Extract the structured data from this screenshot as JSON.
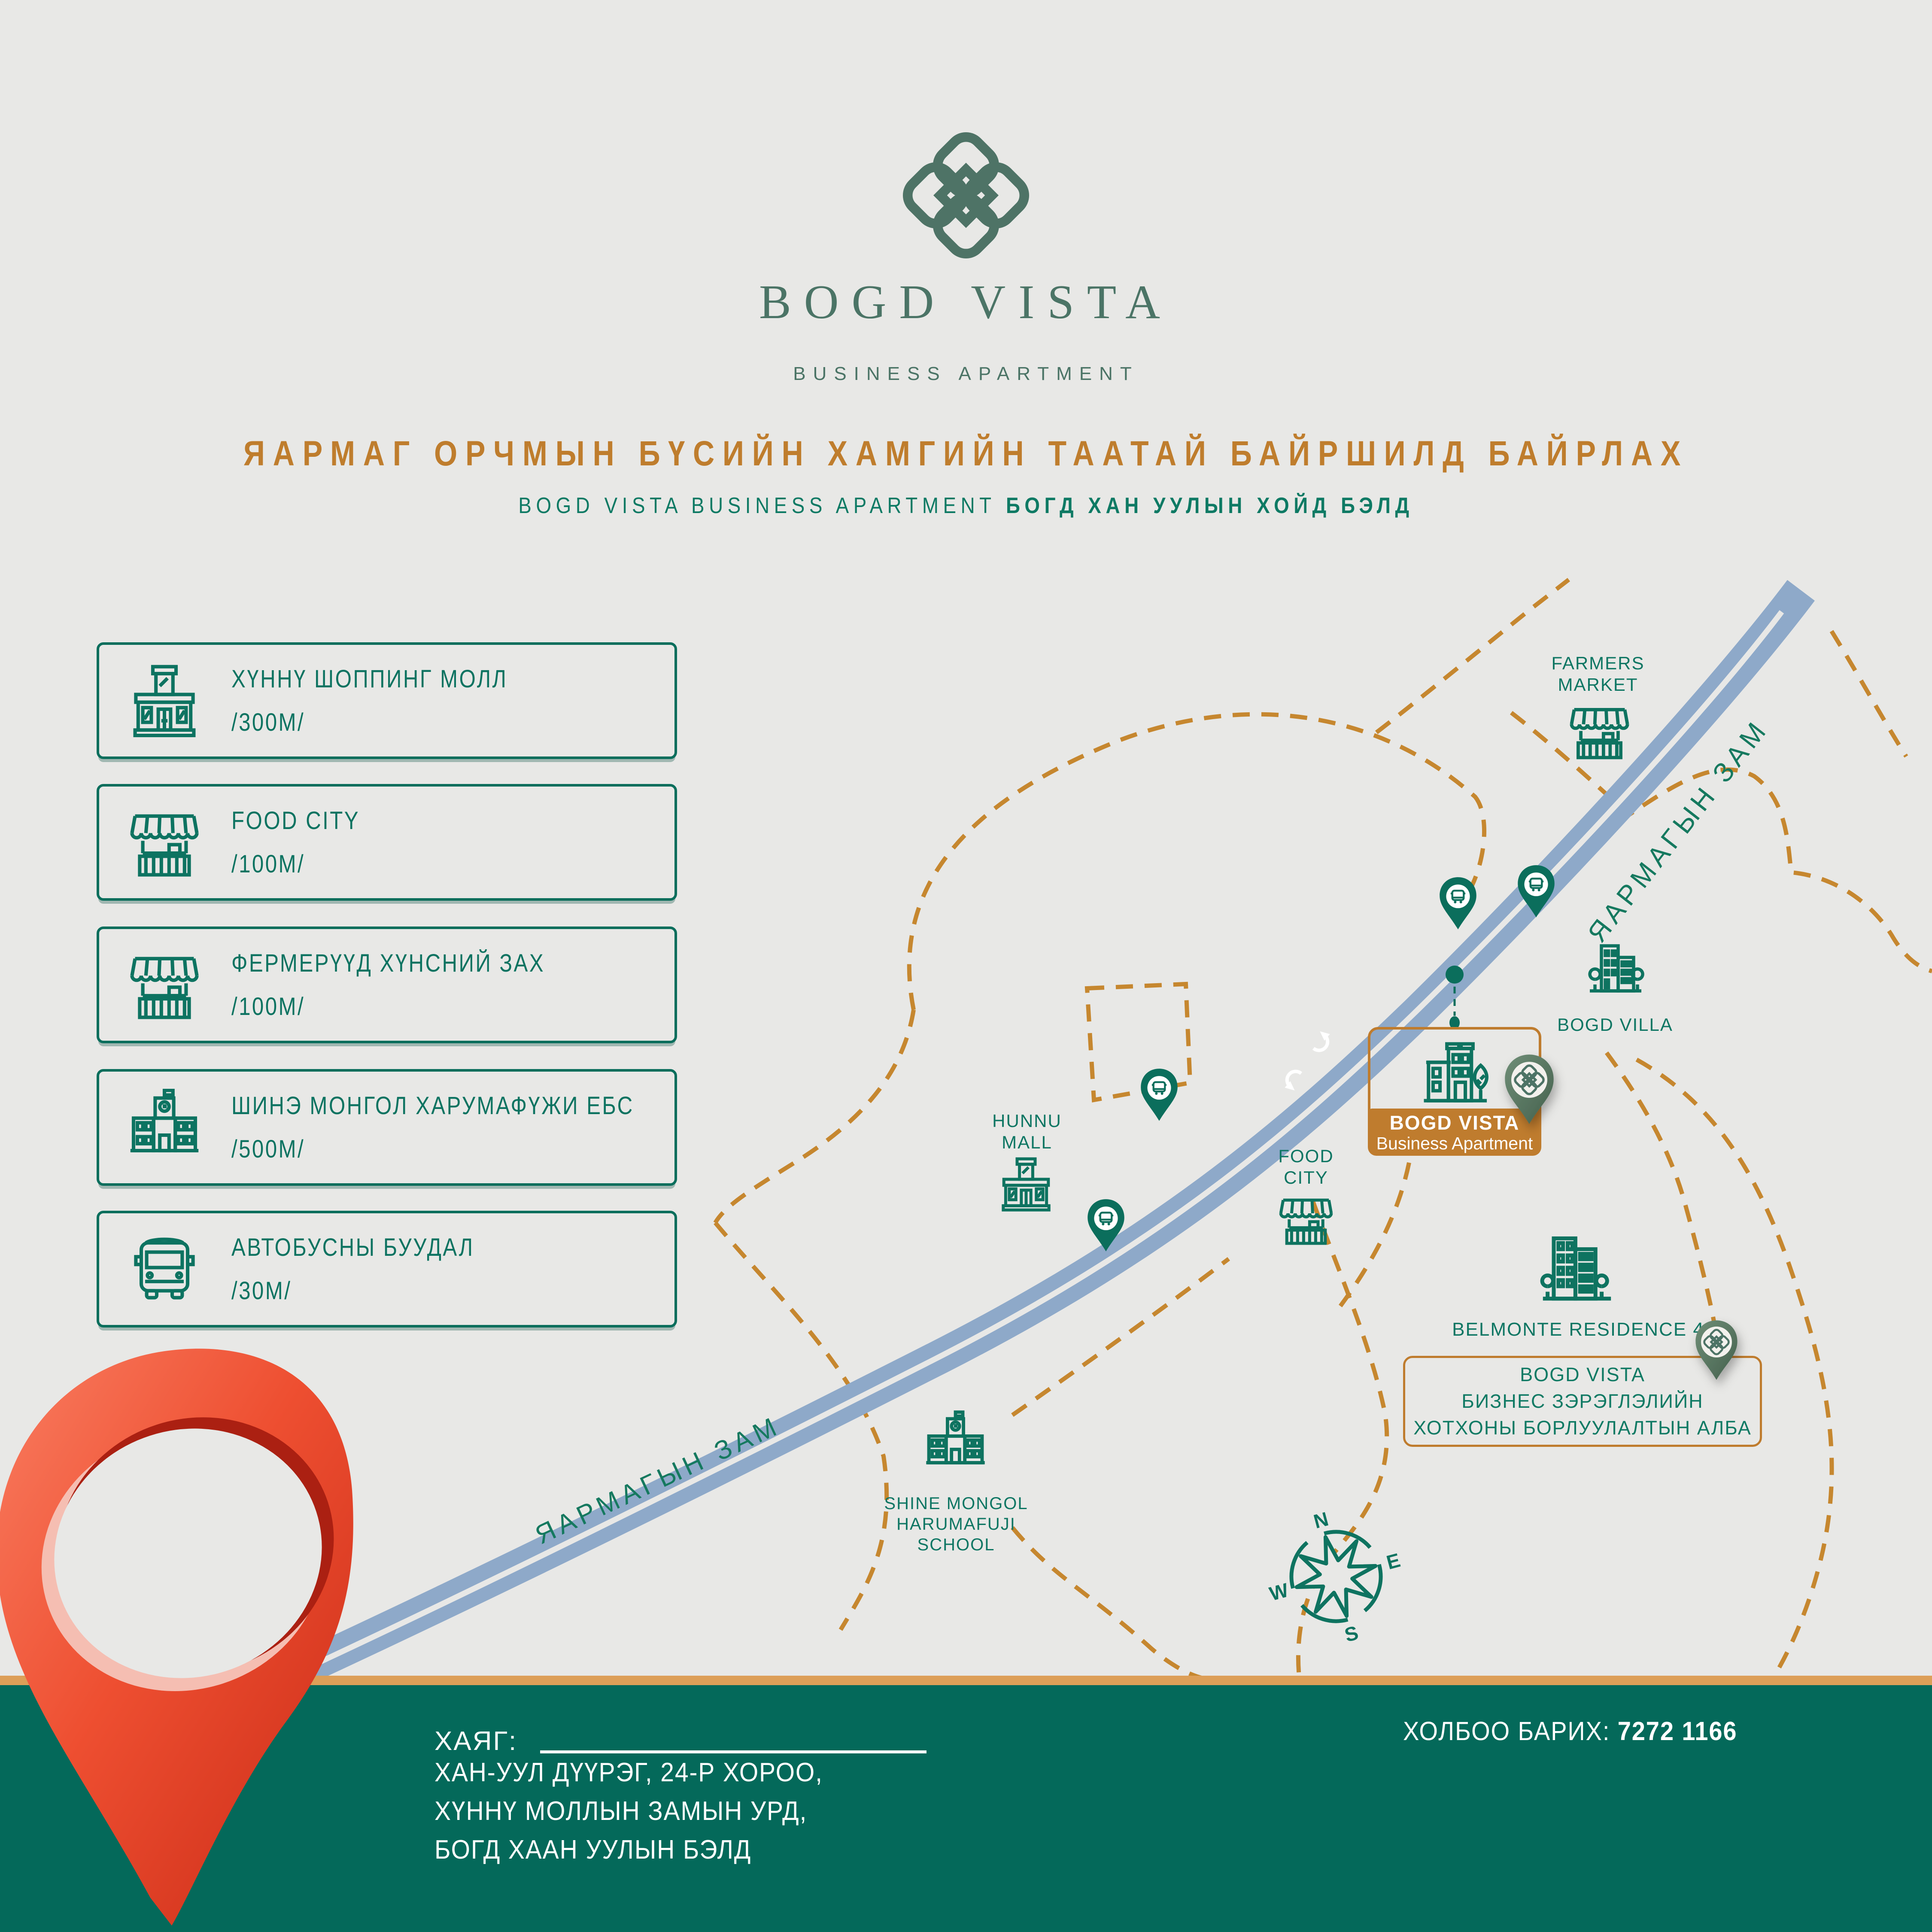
{
  "brand": {
    "name": "BOGD VISTA",
    "tagline": "BUSINESS APARTMENT",
    "logo_icon": "endless-knot-icon"
  },
  "headline": "ЯАРМАГ ОРЧМЫН БҮСИЙН ХАМГИЙН ТААТАЙ БАЙРШИЛД БАЙРЛАХ",
  "subheadline": {
    "latin": "BOGD VISTA BUSINESS APARTMENT",
    "bold": "БОГД ХАН УУЛЫН ХОЙД БЭЛД"
  },
  "amenities": [
    {
      "icon": "mall-icon",
      "label": "ХҮННҮ ШОППИНГ МОЛЛ",
      "distance": "/300М/"
    },
    {
      "icon": "market-icon",
      "label": "FOOD CITY",
      "distance": "/100М/"
    },
    {
      "icon": "market-icon",
      "label": "ФЕРМЕРҮҮД ХҮНСНИЙ ЗАХ",
      "distance": "/100М/"
    },
    {
      "icon": "school-icon",
      "label": "ШИНЭ МОНГОЛ ХАРУМАФҮЖИ ЕБС",
      "distance": "/500М/"
    },
    {
      "icon": "bus-icon",
      "label": "АВТОБУСНЫ БУУДАЛ",
      "distance": "/30М/"
    }
  ],
  "map": {
    "road_label": "ЯАРМАГЫН ЗАМ",
    "labels": {
      "farmers_market": [
        "FARMERS",
        "MARKET"
      ],
      "hunnu_mall": [
        "HUNNU",
        "MALL"
      ],
      "food_city": [
        "FOOD",
        "CITY"
      ],
      "bogd_villa": "BOGD VILLA",
      "belmonte": "BELMONTE RESIDENCE 4",
      "school": [
        "SHINE MONGOL",
        "HARUMAFUJI",
        "SCHOOL"
      ]
    },
    "main_card": {
      "title": "BOGD VISTA",
      "subtitle": "Business Apartment"
    },
    "sales_office": [
      "BOGD VISTA",
      "БИЗНЕС ЗЭРЭГЛЭЛИЙН",
      "ХОТХОНЫ БОРЛУУЛАЛТЫН АЛБА"
    ],
    "compass": {
      "n": "N",
      "e": "E",
      "s": "S",
      "w": "W"
    },
    "marker_icons": [
      "bus-stop-pin-icon",
      "logo-pin-icon",
      "location-pin-icon"
    ]
  },
  "footer": {
    "address_label": "ХАЯГ:",
    "address_lines": [
      "ХАН-УУЛ ДҮҮРЭГ, 24-Р ХОРОО,",
      "ХҮННҮ МОЛЛЫН ЗАМЫН УРД,",
      "БОГД ХААН УУЛЫН БЭЛД"
    ],
    "contact_label": "ХОЛБОО БАРИХ:",
    "phone": "7272 1166"
  },
  "colors": {
    "background": "#e8e8e6",
    "teal_green": "#0c7160",
    "logo_green": "#4b7466",
    "accent_orange": "#bf7d2d",
    "dash_orange": "#c6872f",
    "road_blue": "#8ea9c9",
    "footer_green": "#04695a",
    "strip_orange": "#dd9f58",
    "pin_red": "#e2392a"
  }
}
